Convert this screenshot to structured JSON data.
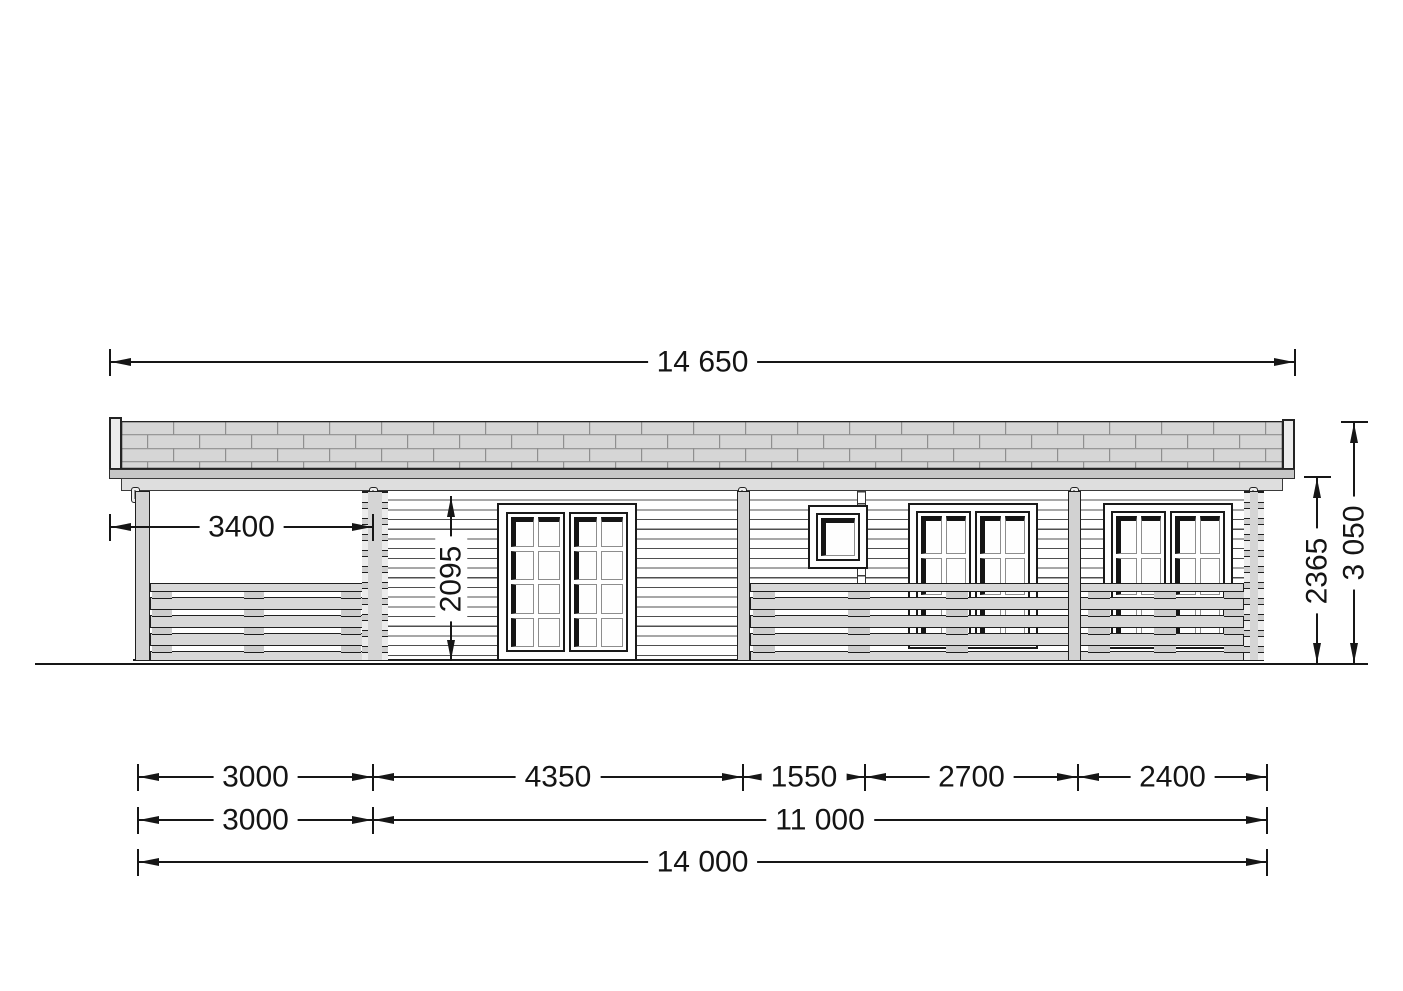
{
  "drawing": {
    "kind": "log-cabin front elevation",
    "colors": {
      "line": "#161616",
      "roof_fill": "#d6d6d6",
      "roof_line": "#909090",
      "wood_fill": "#d5d5d5",
      "background": "#ffffff"
    }
  },
  "dimensions": {
    "overall_width_with_overhang": "14 650",
    "porch_depth": "3400",
    "door_height": "2095",
    "wall_height": "2365",
    "total_height": "3 050",
    "bottom_row1": [
      "3000",
      "4350",
      "1550",
      "2700",
      "2400"
    ],
    "bottom_row2": [
      "3000",
      "11 000"
    ],
    "bottom_total": "14 000"
  }
}
